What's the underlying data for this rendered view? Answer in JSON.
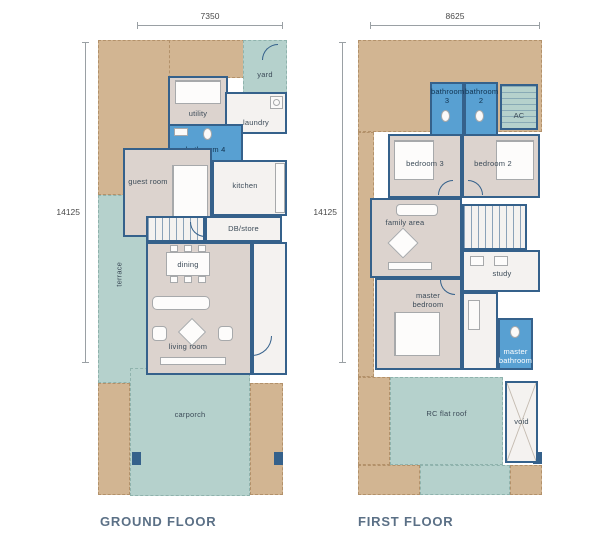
{
  "sheet": {
    "type": "floor-plan",
    "colors": {
      "landscape_tan": "#d2b592",
      "paved_teal": "#b5d1cc",
      "room_floor": "#dcd3ce",
      "wall_blue": "#35618b",
      "bathroom_blue": "#58a0d2",
      "title_color": "#5b7086"
    }
  },
  "ground_floor": {
    "title": "GROUND FLOOR",
    "width_dim": "7350",
    "height_dim": "14125",
    "rooms": {
      "yard": "yard",
      "utility": "utility",
      "laundry": "laundry",
      "bathroom4": "bathroom 4",
      "guest_room": "guest room",
      "kitchen": "kitchen",
      "db_store": "DB/store",
      "terrace": "terrace",
      "dining": "dining",
      "living_room": "living room",
      "carporch": "carporch"
    }
  },
  "first_floor": {
    "title": "FIRST FLOOR",
    "width_dim": "8625",
    "height_dim": "14125",
    "rooms": {
      "bathroom3": "bathroom 3",
      "bathroom2": "bathroom 2",
      "ac": "AC",
      "bedroom3": "bedroom 3",
      "bedroom2": "bedroom 2",
      "family_area": "family area",
      "study": "study",
      "master_bedroom": "master bedroom",
      "master_bathroom": "master bathroom",
      "rc_flat_roof": "RC flat roof",
      "void": "void"
    }
  }
}
